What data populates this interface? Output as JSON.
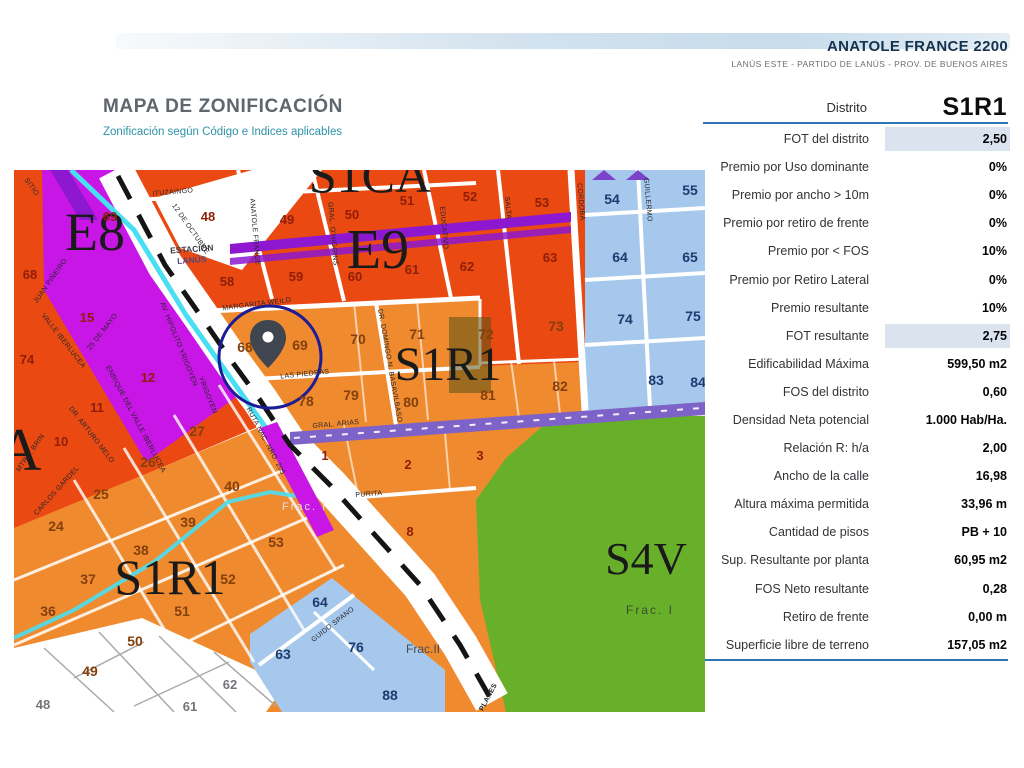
{
  "header": {
    "title": "ANATOLE FRANCE 2200",
    "subtitle": "LANÚS ESTE - PARTIDO DE LANÚS - PROV. DE BUENOS AIRES"
  },
  "map_header": {
    "title": "MAPA DE ZONIFICACIÓN",
    "subtitle": "Zonificación según Código e Indices aplicables"
  },
  "panel": {
    "district_label": "Distrito",
    "district_value": "S1R1",
    "rows": [
      {
        "label": "FOT del distrito",
        "value": "2,50",
        "highlight": true
      },
      {
        "label": "Premio por Uso dominante",
        "value": "0%",
        "highlight": false
      },
      {
        "label": "Premio por ancho > 10m",
        "value": "0%",
        "highlight": false
      },
      {
        "label": "Premio por retiro de frente",
        "value": "0%",
        "highlight": false
      },
      {
        "label": "Premio por < FOS",
        "value": "10%",
        "highlight": false
      },
      {
        "label": "Premio por Retiro Lateral",
        "value": "0%",
        "highlight": false
      },
      {
        "label": "Premio resultante",
        "value": "10%",
        "highlight": false
      },
      {
        "label": "FOT resultante",
        "value": "2,75",
        "highlight": true
      },
      {
        "label": "Edificabilidad Máxima",
        "value": "599,50 m2",
        "highlight": false
      },
      {
        "label": "FOS del distrito",
        "value": "0,60",
        "highlight": false
      },
      {
        "label": "Densidad Neta potencial",
        "value": "1.000 Hab/Ha.",
        "highlight": false
      },
      {
        "label": "Relación R: h/a",
        "value": "2,00",
        "highlight": false
      },
      {
        "label": "Ancho de la calle",
        "value": "16,98",
        "highlight": false
      },
      {
        "label": "Altura máxima permitida",
        "value": "33,96 m",
        "highlight": false
      },
      {
        "label": "Cantidad de pisos",
        "value": "PB + 10",
        "highlight": false
      },
      {
        "label": "Sup. Resultante por planta",
        "value": "60,95 m2",
        "highlight": false
      },
      {
        "label": "FOS Neto resultante",
        "value": "0,28",
        "highlight": false
      },
      {
        "label": "Retiro de frente",
        "value": "0,00 m",
        "highlight": false
      },
      {
        "label": "Superficie libre de terreno",
        "value": "157,05 m2",
        "highlight": false
      }
    ]
  },
  "map": {
    "colors": {
      "red_zone": "#ea4a12",
      "orange_zone": "#f08a2e",
      "magenta_zone": "#c816e6",
      "purple_corridor": "#8d18d0",
      "violet_avenue": "#7d62c8",
      "blue_zone": "#a5c8ec",
      "green_zone": "#69b02a",
      "cyan_rail": "#49dff2",
      "circle_marker": "#1c1c96",
      "panel_rule": "#2e75b6",
      "highlight_cell": "#dbe4ee"
    },
    "zones": [
      {
        "text": "E8"
      },
      {
        "text": "E9"
      },
      {
        "text": "S1CA"
      },
      {
        "text": "S1R1"
      },
      {
        "text": "S1R1"
      },
      {
        "text": "S4V"
      },
      {
        "text": "A"
      }
    ],
    "fracs": [
      {
        "text": "Frac. I"
      },
      {
        "text": "Frac. I"
      },
      {
        "text": "Frac.II"
      }
    ],
    "station": {
      "line1": "ESTACIÓN",
      "line2": "LANÚS"
    },
    "streets": [
      {
        "text": "ITUZAINGO"
      },
      {
        "text": "ANATOLE FRANCE"
      },
      {
        "text": "GRAL. O'HIGGINS"
      },
      {
        "text": "EDUCATIVO"
      },
      {
        "text": "SALTA"
      },
      {
        "text": "CORDOBA"
      },
      {
        "text": "GUILLERMO"
      },
      {
        "text": "MARGARITA WEILD"
      },
      {
        "text": "LAS PIEDRAS"
      },
      {
        "text": "GRAL. ARIAS"
      },
      {
        "text": "DR. DOMINGO N. BASAVILBASO"
      },
      {
        "text": "PURITA"
      },
      {
        "text": "GUIDO SPANO"
      },
      {
        "text": "RUTA NAC. NRO. 205"
      },
      {
        "text": "AV. HIPOLITO YRIGOYEN"
      },
      {
        "text": "12 DE OCTUBRE"
      },
      {
        "text": "SITIO"
      },
      {
        "text": "JUAN PIÑEIRO"
      },
      {
        "text": "VALLE IBERLUCEA"
      },
      {
        "text": "25 DE MAYO"
      },
      {
        "text": "ENRIQUE DEL VALLE IBERLUCEA"
      },
      {
        "text": "DR. ARTURO MELO"
      },
      {
        "text": "CARLOS GARDEL"
      },
      {
        "text": "MTRO. BRIN"
      },
      {
        "text": "PLANES"
      },
      {
        "text": "YRIGOYEN"
      }
    ],
    "parcels": [
      {
        "text": "48"
      },
      {
        "text": "49"
      },
      {
        "text": "50"
      },
      {
        "text": "51"
      },
      {
        "text": "52"
      },
      {
        "text": "53"
      },
      {
        "text": "58"
      },
      {
        "text": "59"
      },
      {
        "text": "60"
      },
      {
        "text": "61"
      },
      {
        "text": "62"
      },
      {
        "text": "63"
      },
      {
        "text": "69"
      },
      {
        "text": "15"
      },
      {
        "text": "68"
      },
      {
        "text": "74"
      },
      {
        "text": "10"
      },
      {
        "text": "11"
      },
      {
        "text": "12"
      },
      {
        "text": "1"
      },
      {
        "text": "2"
      },
      {
        "text": "3"
      },
      {
        "text": "8"
      },
      {
        "text": "68"
      },
      {
        "text": "69"
      },
      {
        "text": "70"
      },
      {
        "text": "71"
      },
      {
        "text": "72"
      },
      {
        "text": "73"
      },
      {
        "text": "78"
      },
      {
        "text": "79"
      },
      {
        "text": "80"
      },
      {
        "text": "81"
      },
      {
        "text": "82"
      },
      {
        "text": "27"
      },
      {
        "text": "26"
      },
      {
        "text": "25"
      },
      {
        "text": "24"
      },
      {
        "text": "40"
      },
      {
        "text": "39"
      },
      {
        "text": "38"
      },
      {
        "text": "37"
      },
      {
        "text": "52"
      },
      {
        "text": "53"
      },
      {
        "text": "36"
      },
      {
        "text": "51"
      },
      {
        "text": "50"
      },
      {
        "text": "49"
      },
      {
        "text": "54"
      },
      {
        "text": "55"
      },
      {
        "text": "64"
      },
      {
        "text": "65"
      },
      {
        "text": "74"
      },
      {
        "text": "75"
      },
      {
        "text": "83"
      },
      {
        "text": "84"
      },
      {
        "text": "63"
      },
      {
        "text": "64"
      },
      {
        "text": "76"
      },
      {
        "text": "88"
      },
      {
        "text": "48"
      },
      {
        "text": "61"
      },
      {
        "text": "62"
      }
    ]
  }
}
